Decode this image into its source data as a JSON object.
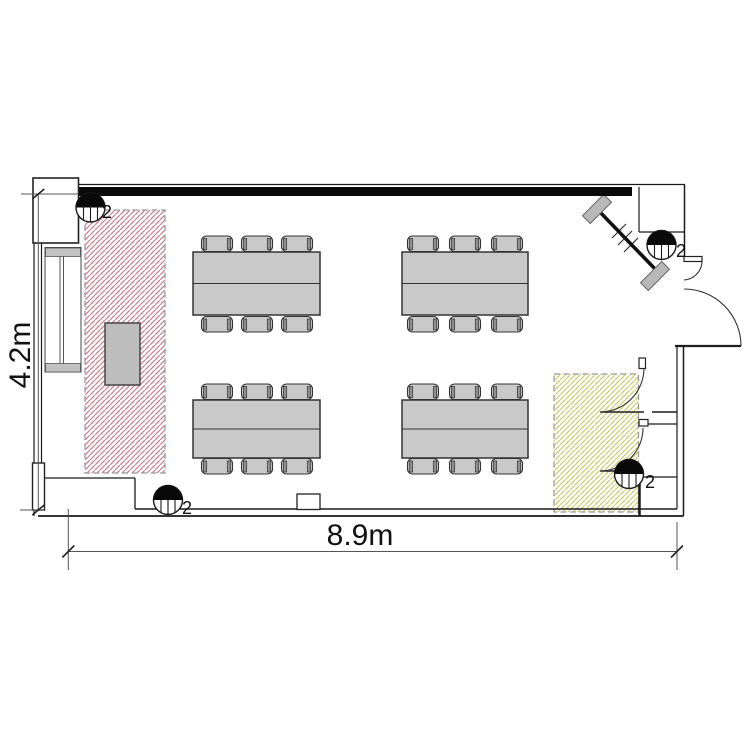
{
  "plan": {
    "type": "floor-plan",
    "room": {
      "width_label": "8.9m",
      "height_label": "4.2m"
    },
    "lights": [
      {
        "label": "2",
        "position": "top-left"
      },
      {
        "label": "2",
        "position": "top-right"
      },
      {
        "label": "2",
        "position": "bottom-left"
      },
      {
        "label": "2",
        "position": "bottom-right"
      }
    ],
    "zones": [
      {
        "name": "presenter-zone",
        "hatch_color": "#c9808f"
      },
      {
        "name": "entrance-zone",
        "hatch_color": "#cdcd72"
      }
    ],
    "furniture": {
      "table_groups": 4,
      "chairs_per_table": 6,
      "lecterns": 1
    },
    "colors": {
      "furniture_fill": "#c9c9c9",
      "wall": "#111111",
      "zone_border": "#9a9a9a"
    }
  }
}
